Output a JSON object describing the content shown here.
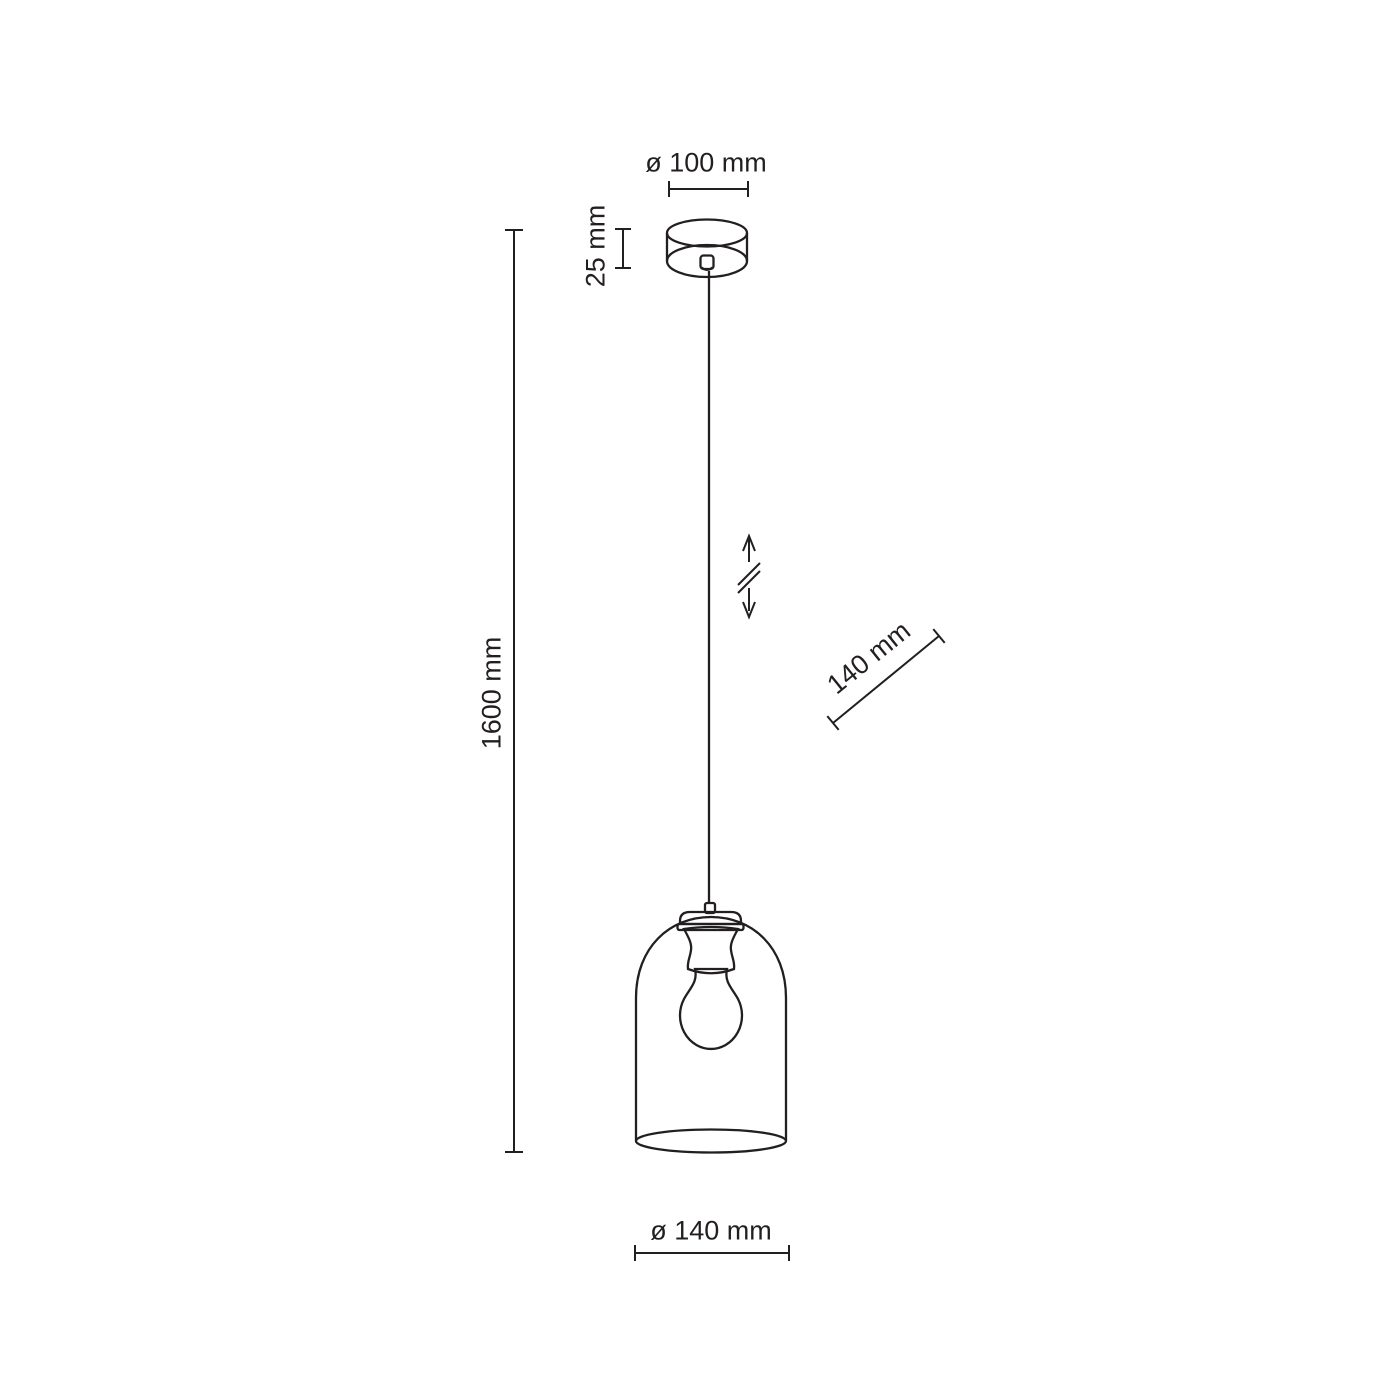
{
  "drawing": {
    "background_color": "#ffffff",
    "line_color": "#231f20",
    "dimensions": {
      "canopy_diameter": "ø 100 mm",
      "canopy_height": "25 mm",
      "total_height": "1600 mm",
      "shade_height": "140 mm",
      "shade_diameter": "ø 140 mm"
    },
    "icons": {
      "height_adjustment": "up-down-arrows-with-break"
    }
  }
}
